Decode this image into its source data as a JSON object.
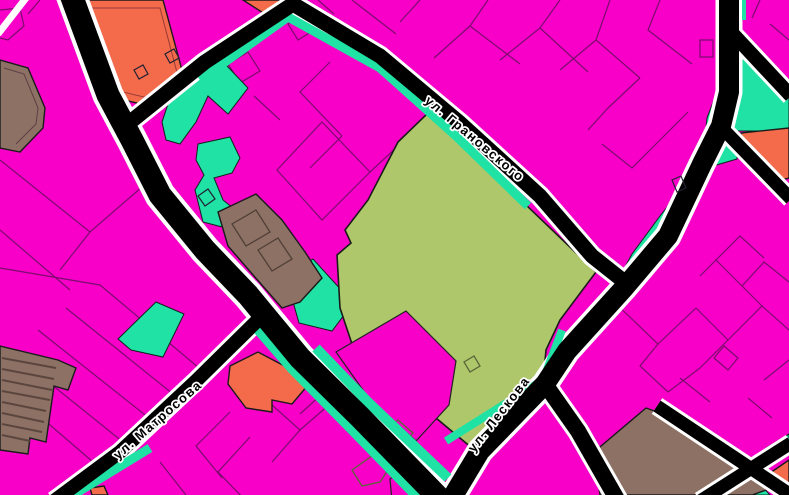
{
  "map": {
    "streets": [
      {
        "id": "granovskogo",
        "label": "ул. Грановского"
      },
      {
        "id": "matrosova",
        "label": "ул. Матросова"
      },
      {
        "id": "leskova",
        "label": "ул. Лескова"
      }
    ],
    "colors": {
      "zone_magenta": "#f800c8",
      "zone_cyan": "#1fe2a4",
      "zone_olive": "#adc76a",
      "zone_orange": "#f46b4c",
      "zone_brown": "#8d7164",
      "parcel_line": "#7c0c6e",
      "road_fill": "#000000",
      "road_casing": "#ffffff",
      "label_fill": "#000000",
      "label_halo": "#ffffff",
      "building_line_olive": "#5a6638",
      "building_line_brown": "#4f3f37"
    }
  }
}
